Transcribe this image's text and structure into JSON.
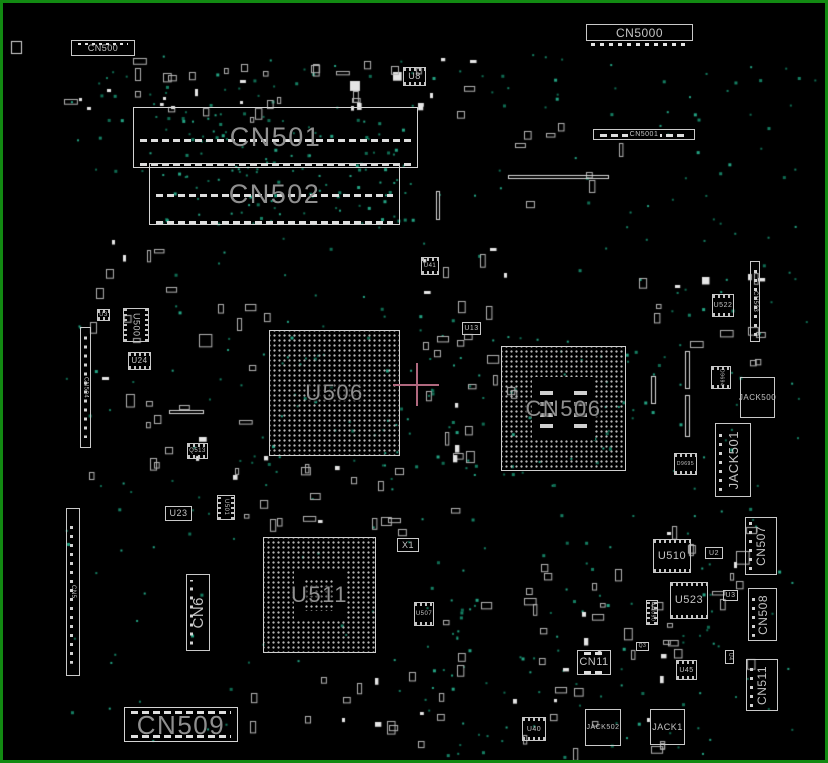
{
  "board": {
    "background": "#000000",
    "border_color": "#128a12",
    "outline_color": "#c9c9c9",
    "big_label_color": "#8f8f8f",
    "small_label_color": "#c4c4c4",
    "testpoint_color": "#1a9678",
    "crosshair": {
      "x": 413,
      "y": 381,
      "arm_h": 46,
      "arm_v": 43,
      "color": "#b0697f"
    }
  },
  "components": [
    {
      "id": "CN500",
      "label": "CN500",
      "type": "conn",
      "x": 68,
      "y": 37,
      "w": 64,
      "h": 16,
      "ls": 9,
      "pads": "top"
    },
    {
      "id": "CN5000",
      "label": "CN5000",
      "type": "conn",
      "x": 583,
      "y": 21,
      "w": 107,
      "h": 17,
      "ls": 12,
      "pads": "below"
    },
    {
      "id": "CN501",
      "label": "CN501",
      "type": "slot",
      "x": 130,
      "y": 104,
      "w": 285,
      "h": 61,
      "ls": 27,
      "big": true,
      "rows": [
        0.52,
        0.93
      ]
    },
    {
      "id": "CN502",
      "label": "CN502",
      "type": "slot",
      "x": 146,
      "y": 160,
      "w": 251,
      "h": 62,
      "ls": 27,
      "big": true,
      "rows": [
        0.5,
        0.95
      ]
    },
    {
      "id": "CN5001",
      "label": "CN5001",
      "type": "conn",
      "x": 590,
      "y": 126,
      "w": 102,
      "h": 11,
      "ls": 7,
      "rows": [
        0.45
      ],
      "bgmask": true
    },
    {
      "id": "U8",
      "label": "U8",
      "type": "ic",
      "x": 400,
      "y": 64,
      "w": 23,
      "h": 19,
      "ls": 9
    },
    {
      "id": "U41",
      "label": "U41",
      "type": "ic",
      "x": 418,
      "y": 254,
      "w": 18,
      "h": 18,
      "ls": 6
    },
    {
      "id": "CN503",
      "label": "CN503",
      "type": "vconn",
      "x": 747,
      "y": 258,
      "w": 10,
      "h": 81,
      "ls": 6,
      "lo": "v"
    },
    {
      "id": "U522",
      "label": "U522",
      "type": "ic",
      "x": 709,
      "y": 291,
      "w": 22,
      "h": 23,
      "ls": 7
    },
    {
      "id": "U500",
      "label": "U500",
      "type": "ic",
      "x": 120,
      "y": 305,
      "w": 26,
      "h": 34,
      "ls": 9,
      "lo": "v"
    },
    {
      "id": "U3A",
      "label": "U3",
      "type": "ic",
      "x": 94,
      "y": 306,
      "w": 13,
      "h": 12,
      "ls": 6
    },
    {
      "id": "CN504",
      "label": "CN504",
      "type": "vconn",
      "x": 77,
      "y": 324,
      "w": 11,
      "h": 121,
      "ls": 6,
      "lo": "v"
    },
    {
      "id": "U24",
      "label": "U24",
      "type": "ic",
      "x": 125,
      "y": 349,
      "w": 23,
      "h": 18,
      "ls": 8
    },
    {
      "id": "U506",
      "label": "U506",
      "type": "bga",
      "x": 266,
      "y": 327,
      "w": 131,
      "h": 126,
      "ls": 22,
      "big": true
    },
    {
      "id": "U13",
      "label": "U13",
      "type": "conn",
      "x": 459,
      "y": 319,
      "w": 19,
      "h": 13,
      "ls": 7
    },
    {
      "id": "CN506",
      "label": "CN506",
      "type": "bga-ring",
      "x": 498,
      "y": 343,
      "w": 125,
      "h": 125,
      "ls": 22,
      "big": true
    },
    {
      "id": "D9694",
      "label": "D9694",
      "type": "ic",
      "x": 708,
      "y": 363,
      "w": 20,
      "h": 23,
      "ls": 5,
      "lo": "v"
    },
    {
      "id": "JACK500",
      "label": "JACK500",
      "type": "conn",
      "x": 737,
      "y": 374,
      "w": 35,
      "h": 41,
      "ls": 8
    },
    {
      "id": "JACK501",
      "label": "JACK501",
      "type": "vconn",
      "x": 712,
      "y": 420,
      "w": 36,
      "h": 74,
      "ls": 13,
      "lo": "vu"
    },
    {
      "id": "D9695",
      "label": "D9695",
      "type": "ic",
      "x": 671,
      "y": 450,
      "w": 23,
      "h": 22,
      "ls": 5
    },
    {
      "id": "Q513",
      "label": "Q513",
      "type": "ic",
      "x": 184,
      "y": 440,
      "w": 21,
      "h": 16,
      "ls": 6
    },
    {
      "id": "U23",
      "label": "U23",
      "type": "conn",
      "x": 162,
      "y": 503,
      "w": 27,
      "h": 15,
      "ls": 9
    },
    {
      "id": "U501",
      "label": "U501",
      "type": "ic",
      "x": 214,
      "y": 492,
      "w": 18,
      "h": 25,
      "ls": 6,
      "lo": "v"
    },
    {
      "id": "CN6",
      "label": "CN6",
      "type": "vconn",
      "x": 183,
      "y": 571,
      "w": 24,
      "h": 77,
      "ls": 15,
      "lo": "vu"
    },
    {
      "id": "CN5",
      "label": "CN5",
      "type": "vconn",
      "x": 63,
      "y": 505,
      "w": 14,
      "h": 168,
      "ls": 6,
      "lo": "v"
    },
    {
      "id": "U511",
      "label": "U511",
      "type": "bga",
      "x": 260,
      "y": 534,
      "w": 113,
      "h": 116,
      "ls": 22,
      "big": true,
      "center": true
    },
    {
      "id": "X1",
      "label": "X1",
      "type": "conn",
      "x": 394,
      "y": 535,
      "w": 22,
      "h": 14,
      "ls": 9
    },
    {
      "id": "U507",
      "label": "U507",
      "type": "ic",
      "x": 411,
      "y": 599,
      "w": 20,
      "h": 24,
      "ls": 6
    },
    {
      "id": "U510",
      "label": "U510",
      "type": "ic",
      "x": 650,
      "y": 536,
      "w": 38,
      "h": 34,
      "ls": 11
    },
    {
      "id": "U2",
      "label": "U2",
      "type": "conn",
      "x": 702,
      "y": 544,
      "w": 18,
      "h": 12,
      "ls": 7
    },
    {
      "id": "CN507",
      "label": "CN507",
      "type": "vconn",
      "x": 742,
      "y": 514,
      "w": 32,
      "h": 58,
      "ls": 12,
      "lo": "vu"
    },
    {
      "id": "U523",
      "label": "U523",
      "type": "ic",
      "x": 667,
      "y": 579,
      "w": 38,
      "h": 37,
      "ls": 11
    },
    {
      "id": "U3B",
      "label": "U3",
      "type": "conn",
      "x": 720,
      "y": 587,
      "w": 15,
      "h": 11,
      "ls": 7
    },
    {
      "id": "CN508",
      "label": "CN508",
      "type": "vconn",
      "x": 745,
      "y": 585,
      "w": 29,
      "h": 53,
      "ls": 12,
      "lo": "vu"
    },
    {
      "id": "U1090",
      "label": "U1090",
      "type": "ic",
      "x": 643,
      "y": 597,
      "w": 12,
      "h": 25,
      "ls": 5,
      "lo": "v"
    },
    {
      "id": "U4",
      "label": "U4",
      "type": "conn",
      "x": 722,
      "y": 647,
      "w": 9,
      "h": 14,
      "ls": 5,
      "lo": "v"
    },
    {
      "id": "CN511",
      "label": "CN511",
      "type": "vconn",
      "x": 743,
      "y": 656,
      "w": 32,
      "h": 52,
      "ls": 12,
      "lo": "vu"
    },
    {
      "id": "U45",
      "label": "U45",
      "type": "ic",
      "x": 673,
      "y": 657,
      "w": 21,
      "h": 20,
      "ls": 7
    },
    {
      "id": "Q3",
      "label": "Q3",
      "type": "conn",
      "x": 633,
      "y": 639,
      "w": 13,
      "h": 9,
      "ls": 5
    },
    {
      "id": "CN11",
      "label": "CN11",
      "type": "conn",
      "x": 574,
      "y": 647,
      "w": 34,
      "h": 25,
      "ls": 11,
      "rows": [
        0.06,
        0.85
      ]
    },
    {
      "id": "U40",
      "label": "U40",
      "type": "ic",
      "x": 519,
      "y": 714,
      "w": 24,
      "h": 24,
      "ls": 7
    },
    {
      "id": "JACK502",
      "label": "JACK502",
      "type": "conn",
      "x": 582,
      "y": 706,
      "w": 36,
      "h": 37,
      "ls": 7
    },
    {
      "id": "JACK1",
      "label": "JACK1",
      "type": "conn",
      "x": 647,
      "y": 706,
      "w": 35,
      "h": 36,
      "ls": 9
    },
    {
      "id": "CN509",
      "label": "CN509",
      "type": "slot",
      "x": 121,
      "y": 704,
      "w": 114,
      "h": 35,
      "ls": 26,
      "big": true,
      "rows": [
        0.1,
        0.82
      ]
    }
  ],
  "decor": {
    "seed": 42,
    "test_point_colors": [
      "#157f63",
      "#23a383",
      "#0f6b52"
    ],
    "outline_color": "#b3b3b3",
    "pad_color": "#e6e6e6",
    "dot_regions": [
      {
        "x": 60,
        "y": 50,
        "w": 740,
        "h": 690,
        "n": 230
      },
      {
        "x": 135,
        "y": 108,
        "w": 275,
        "h": 112,
        "n": 120
      },
      {
        "x": 250,
        "y": 300,
        "w": 200,
        "h": 170,
        "n": 40
      },
      {
        "x": 470,
        "y": 325,
        "w": 200,
        "h": 165,
        "n": 30
      },
      {
        "x": 420,
        "y": 555,
        "w": 290,
        "h": 200,
        "n": 60
      },
      {
        "x": 600,
        "y": 60,
        "w": 215,
        "h": 460,
        "n": 45
      },
      {
        "x": 60,
        "y": 50,
        "w": 500,
        "h": 60,
        "n": 30
      }
    ],
    "passive_regions": [
      {
        "x": 60,
        "y": 55,
        "w": 250,
        "h": 60,
        "n": 26
      },
      {
        "x": 300,
        "y": 55,
        "w": 170,
        "h": 60,
        "n": 18
      },
      {
        "x": 85,
        "y": 230,
        "w": 180,
        "h": 240,
        "n": 30
      },
      {
        "x": 400,
        "y": 240,
        "w": 110,
        "h": 230,
        "n": 26
      },
      {
        "x": 215,
        "y": 460,
        "w": 250,
        "h": 70,
        "n": 20
      },
      {
        "x": 430,
        "y": 560,
        "w": 240,
        "h": 190,
        "n": 36
      },
      {
        "x": 615,
        "y": 270,
        "w": 150,
        "h": 120,
        "n": 14
      },
      {
        "x": 620,
        "y": 520,
        "w": 140,
        "h": 140,
        "n": 18
      },
      {
        "x": 230,
        "y": 655,
        "w": 190,
        "h": 95,
        "n": 14
      },
      {
        "x": 480,
        "y": 120,
        "w": 140,
        "h": 80,
        "n": 8
      }
    ],
    "fixed_bars": [
      [
        505,
        172,
        100,
        3
      ],
      [
        682,
        348,
        4,
        37
      ],
      [
        682,
        392,
        4,
        41
      ],
      [
        648,
        373,
        4,
        27
      ],
      [
        166,
        407,
        34,
        3
      ],
      [
        433,
        188,
        3,
        28
      ],
      [
        8,
        38,
        10,
        12
      ]
    ]
  }
}
